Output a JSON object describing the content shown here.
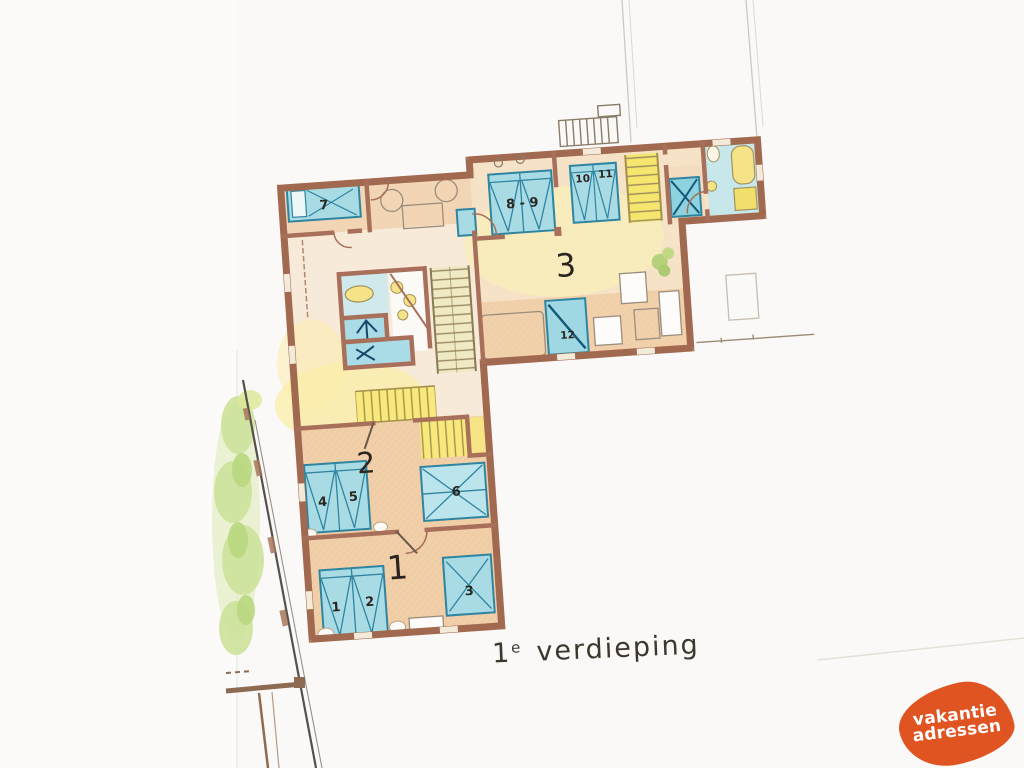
{
  "floorplan": {
    "title": {
      "num": "1",
      "sup": "e",
      "word": "verdieping"
    },
    "rooms": {
      "r1": "1",
      "r2": "2",
      "r3": "3"
    },
    "beds": {
      "b1": "1",
      "b2": "2",
      "b3": "3",
      "b4": "4",
      "b5": "5",
      "b6": "6",
      "b7": "7",
      "b89": "8 - 9",
      "b10": "10",
      "b11": "11",
      "b12": "12"
    }
  },
  "watermark": {
    "line1": "vakantie",
    "line2": "adressen",
    "color": "#df5420"
  },
  "palette": {
    "paper": "#faf9f7",
    "wall": "#b07a5f",
    "wall_dark": "#8c5038",
    "floor_peach": "#f0cfa9",
    "floor_light": "#f8ead8",
    "bed_blue": "#a9dbe5",
    "bed_line": "#2f85a0",
    "stair_yellow": "#f5e76e",
    "bath_cyan": "#c7e7ea",
    "fixture_yellow": "#f4e387",
    "garden_green": "#cde29b"
  }
}
